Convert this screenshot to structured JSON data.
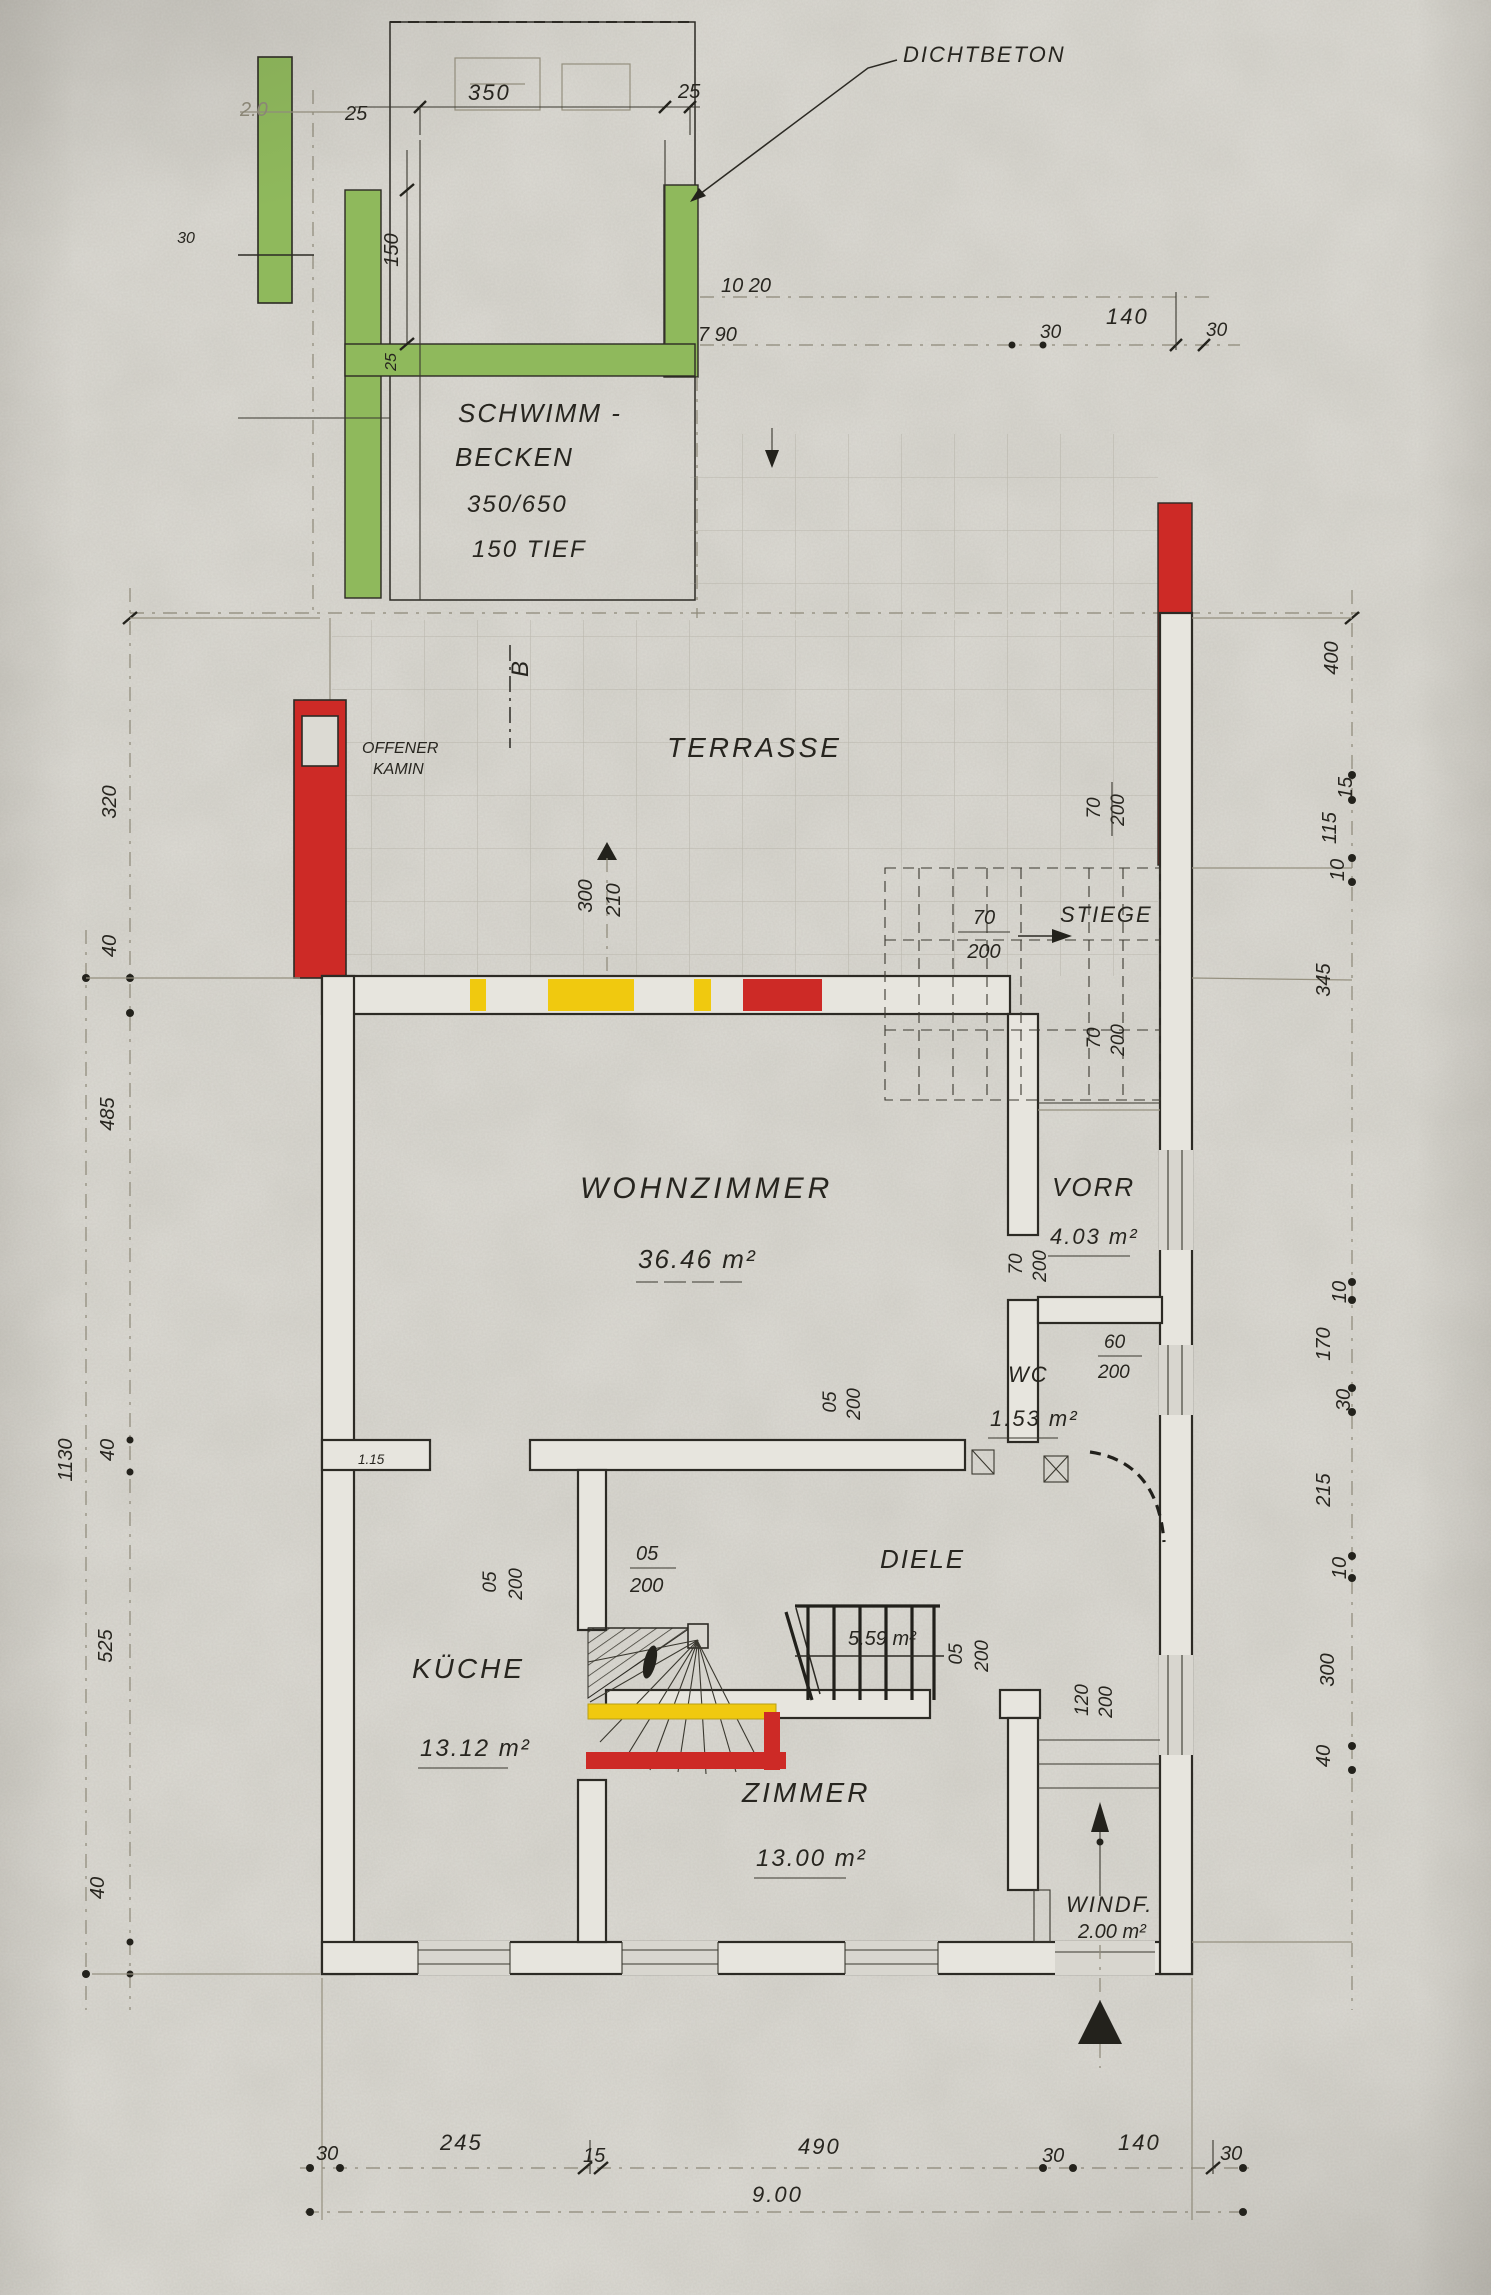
{
  "colors": {
    "paper": "#d4d2cb",
    "ink": "#2c2a24",
    "pencil": "#95907f",
    "green": "#8fb95c",
    "red": "#cd2a26",
    "yellow": "#f0c90f"
  },
  "pool": {
    "callout": "DICHTBETON",
    "t1": "SCHWIMM -",
    "t2": "BECKEN",
    "t3": "350/650",
    "t4": "150 TIEF",
    "d20": "2.0",
    "d25a": "25",
    "d350": "350",
    "d25b": "25",
    "d150": "150",
    "d30": "30",
    "d25c": "25",
    "d1020": "10 20",
    "d790": "7 90"
  },
  "top_chain": {
    "s0": "30",
    "s1": "140",
    "s2": "30"
  },
  "terrace": {
    "label": "TERRASSE",
    "kamin1": "OFFENER",
    "kamin2": "KAMIN",
    "section": "B",
    "door_w": "300",
    "door_h": "210",
    "d70": "70",
    "d200": "200"
  },
  "stiege": {
    "label": "STIEGE",
    "w": "70",
    "h": "200",
    "below_w": "70",
    "below_h": "200"
  },
  "wohnzimmer": {
    "label": "WOHNZIMMER",
    "area": "36.46 m²",
    "door_w": "05",
    "door_h": "200"
  },
  "vorr": {
    "label": "VORR",
    "area": "4.03 m²",
    "door_w": "70",
    "door_h": "200"
  },
  "wc": {
    "label": "WC",
    "area": "1.53 m²",
    "win_w": "60",
    "win_h": "200"
  },
  "kueche": {
    "label": "KÜCHE",
    "area": "13.12 m²",
    "door_w": "05",
    "door_h": "200",
    "pass": "1.15"
  },
  "diele": {
    "label": "DIELE",
    "area": "5.59 m²",
    "door_w": "05",
    "door_h": "200",
    "stair_w": "05",
    "stair_h": "200"
  },
  "zimmer": {
    "label": "ZIMMER",
    "area": "13.00 m²",
    "win_w": "120",
    "win_h": "200"
  },
  "windf": {
    "label": "WINDF.",
    "area": "2.00 m²"
  },
  "left_chain": {
    "total": "1130",
    "s0": "320",
    "s1": "40",
    "s2": "485",
    "s3": "40",
    "s4": "525",
    "s5": "40"
  },
  "right_chain": {
    "s0": "400",
    "s1": "15",
    "s2": "115",
    "s3": "10",
    "s4": "345",
    "s5": "10",
    "s6": "170",
    "s7": "30",
    "s8": "215",
    "s9": "10",
    "s10": "300",
    "s11": "40"
  },
  "bottom_chain": {
    "s0": "30",
    "s1": "245",
    "s2": "15",
    "s3": "490",
    "s4": "30",
    "s5": "140",
    "s6": "30",
    "total": "9.00"
  }
}
